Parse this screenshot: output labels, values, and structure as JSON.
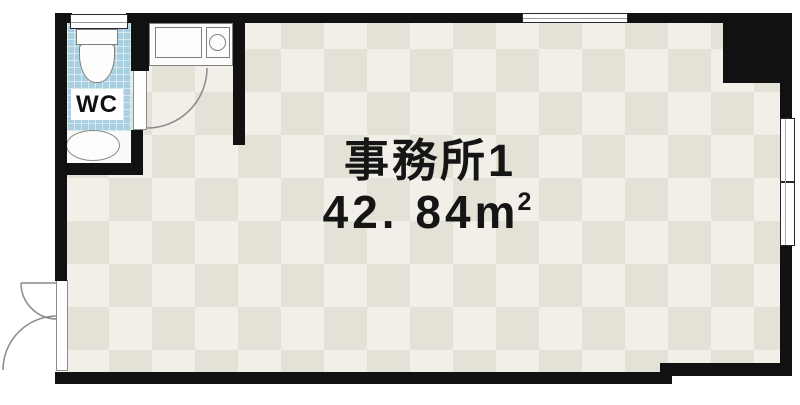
{
  "floorplan": {
    "room": {
      "name": "事務所1",
      "area_value": "42. 84",
      "area_unit": "m",
      "area_unit_exponent": "2",
      "area_text": "42.84㎡"
    },
    "wc": {
      "label": "WC"
    },
    "icons": [
      {
        "name": "toilet-icon",
        "shape": "css rect tank + rounded bowl"
      },
      {
        "name": "wash-basin-icon",
        "shape": "css ellipse"
      },
      {
        "name": "kitchen-sink-icon",
        "shape": "css rect"
      },
      {
        "name": "stove-burner-icon",
        "shape": "css circle"
      },
      {
        "name": "door-swing-icon",
        "shape": "svg quarter-circle arc"
      },
      {
        "name": "window-icon",
        "shape": "white bar with mid line in wall"
      }
    ],
    "colors": {
      "wall": "#111111",
      "floor_light": "#f1efe7",
      "floor_dark": "#e4e1d6",
      "wc_tile_blue": "#a9d0e0",
      "fixture_white": "#ffffff",
      "text": "#151515"
    }
  }
}
